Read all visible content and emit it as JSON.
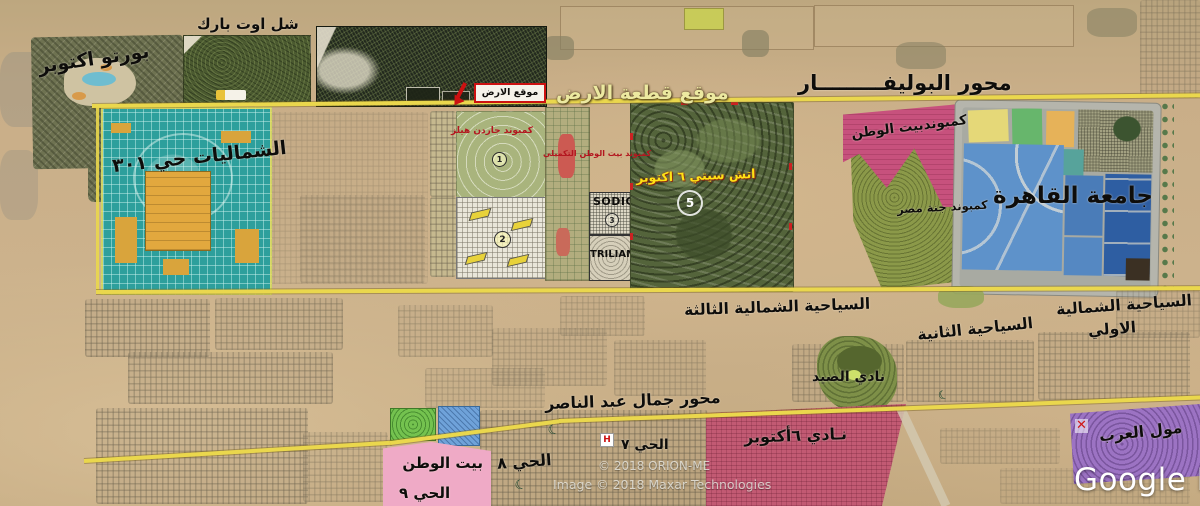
{
  "regions": {
    "porto": {
      "label": "بورتو اكتوبر"
    },
    "chillout_park": {
      "label": "شل اوت بارك"
    },
    "shamaliyat": {
      "label": "الشماليات حي ٣٠١",
      "color": "#2d9f9c"
    },
    "plot": {
      "banner": "موقع قطعة الارض",
      "box_label": "موقع الارض"
    },
    "garden_hills": {
      "label": "كمبوند جاردن هيلز",
      "marker": "1"
    },
    "white_compound": {
      "marker": "2"
    },
    "watan_takmili": {
      "label": "كمبوند بيت الوطن التكميلي"
    },
    "sodic": {
      "label": "SODIC",
      "marker": "3"
    },
    "triliam": {
      "label": "TRILIAM"
    },
    "h_city": {
      "label": "اتش سيتي ٦ اكتوبر",
      "marker": "5"
    },
    "beit_watan_compound": {
      "label": "كمبوندبيت الوطن",
      "color": "#c7517d"
    },
    "ganet_masr": {
      "label": "كمبوند جنة مصر",
      "color": "#8b9949"
    },
    "cairo_university": {
      "label": "جامعة القاهرة",
      "color": "#5e92ca"
    },
    "tourist_north_3": {
      "label": "السياحية الشمالية الثالثة"
    },
    "tourist_2": {
      "label": "السياحية الثانية"
    },
    "tourist_north_1": {
      "label_line1": "السياحية الشمالية",
      "label_line2": "الاولي"
    },
    "hunting_club": {
      "label": "نادي الصيد"
    },
    "october_club": {
      "label": "نـادي ٦أكتوبر",
      "color": "#c25a73"
    },
    "district_7": {
      "label": "الحي ٧"
    },
    "district_8": {
      "label": "الحي ٨"
    },
    "beit_watan_9": {
      "label_line1": "بيت الوطن",
      "label_line2": "الحي ٩",
      "color": "#efaac6"
    },
    "mall_arab": {
      "label": "مول العرب",
      "color": "#9c73c3",
      "x_marker": "✕"
    }
  },
  "roads": {
    "boulevard": {
      "label": "محور البوليفـــــــــار",
      "color": "#ead74d"
    },
    "nasser": {
      "label": "محور جمال عبد الناصر",
      "color": "#ead74d"
    }
  },
  "icons": {
    "hospital": "H",
    "mosque": "☾"
  },
  "watermarks": {
    "google": "Google E",
    "orion": "© 2018 ORION-ME",
    "maxar": "Image © 2018 Maxar Technologies"
  }
}
